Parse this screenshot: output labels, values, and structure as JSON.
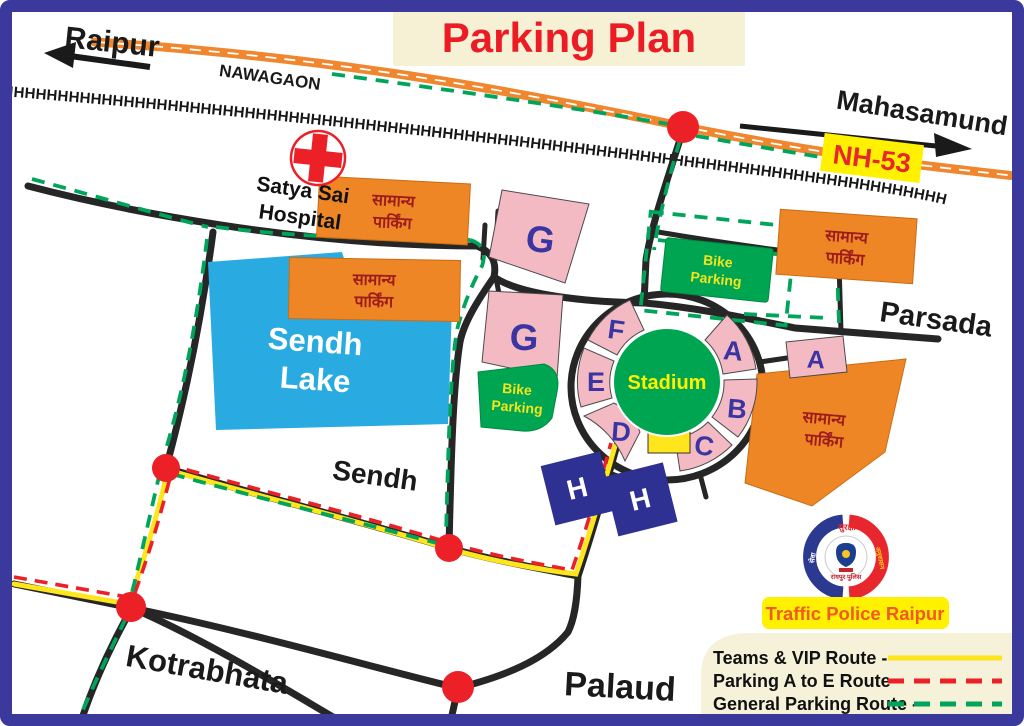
{
  "title": "Parking Plan",
  "places": {
    "raipur": "Raipur",
    "nawagaon": "NAWAGAON",
    "mahasamund": "Mahasamund",
    "nh53": "NH-53",
    "hospital_line1": "Satya Sai",
    "hospital_line2": "Hospital",
    "lake_line1": "Sendh",
    "lake_line2": "Lake",
    "sendh": "Sendh",
    "parsada": "Parsada",
    "kotrabhata": "Kotrabhata",
    "palaud": "Palaud",
    "stadium": "Stadium"
  },
  "parking": {
    "general_line1": "सामान्य",
    "general_line2": "पार्किंग",
    "bike_line1": "Bike",
    "bike_line2": "Parking",
    "zone_a": "A",
    "zone_b": "B",
    "zone_c": "C",
    "zone_d": "D",
    "zone_e": "E",
    "zone_f": "F",
    "zone_g": "G",
    "zone_h": "H"
  },
  "legend": {
    "items": [
      {
        "label": "Teams & VIP Route -",
        "style": "solid",
        "color": "#FFE51C"
      },
      {
        "label": "Parking A to E Route -",
        "style": "dashed",
        "color": "#EC2027"
      },
      {
        "label": "General Parking Route -",
        "style": "dashed",
        "color": "#00A45A"
      }
    ]
  },
  "footer": {
    "traffic_police": "Traffic Police Raipur"
  },
  "logo": {
    "top": "सुरक्षा",
    "left": "सेवा",
    "right": "अनुशासन",
    "caption": "रायपुर पुलिस"
  },
  "railway": {
    "hatch": "HHHHHHHHHHHHHHHHHHHHHHHHHHHHHHHHHHHHHHHHHHHHHHHHHHHHHHHHHHHHHHHHHHHHHHHHHHHHHHHHHHHHHH"
  },
  "colors": {
    "route_vip": "#FFE51C",
    "route_parking_ae": "#EC2027",
    "route_general": "#00A45A",
    "road": "#262626",
    "highway": "#F0862D",
    "lake": "#29ABE2",
    "zone_pink": "#F4BAC4",
    "stadium_green": "#00A551",
    "parking_orange": "#EF8626",
    "h_navy": "#2E3192",
    "junction_red": "#EC2027",
    "title_red": "#EC1C24",
    "cream": "#F6F1D5",
    "border_blue": "#3B3A9C"
  }
}
